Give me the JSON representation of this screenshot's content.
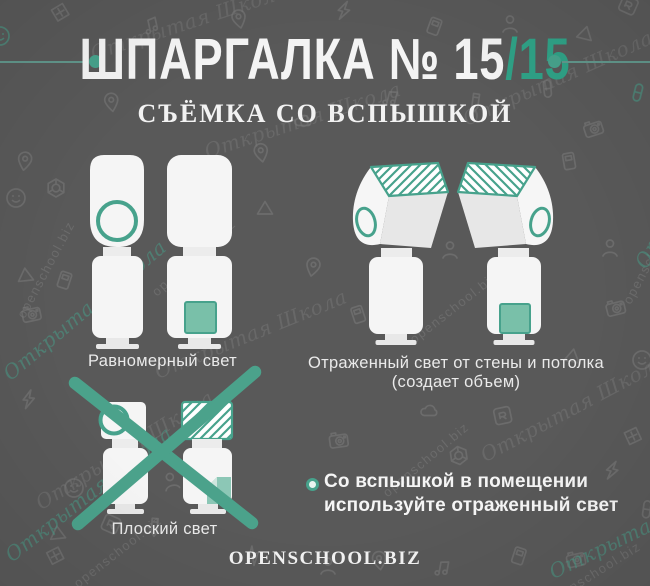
{
  "colors": {
    "background": "#595959",
    "accent_teal": "#47a28c",
    "accent_teal_text": "#2fa186",
    "accent_teal_light": "#79c0a9",
    "pattern_gray": "#6c6c6c",
    "text_white": "#f2f2f2"
  },
  "header": {
    "title_prefix": "ШПАРГАЛКА № 15",
    "title_slash": "/",
    "title_number": "15",
    "subtitle": "СЪЁМКА СО ВСПЫШКОЙ"
  },
  "captions": {
    "even": "Равномерный свет",
    "bounced_line1": "Отраженный свет от стены и потолка",
    "bounced_line2": "(создает объем)",
    "flat": "Плоский свет"
  },
  "tip": {
    "line1": "Со вспышкой в помещении",
    "line2": "используйте отраженный свет"
  },
  "footer": {
    "site": "OPENSCHOOL.BIZ"
  },
  "watermarks": {
    "school_script": "Открытая Школа",
    "school_url": "openschool.biz"
  },
  "background_icons": [
    "smiley-icon",
    "camera-icon",
    "pencil-icon",
    "lightning-icon",
    "triangle-icon",
    "aperture-icon",
    "pin-icon",
    "tag-icon",
    "cloud-icon",
    "person-icon",
    "music-note-icon",
    "diamond-icon",
    "pill-icon",
    "frame-icon"
  ]
}
